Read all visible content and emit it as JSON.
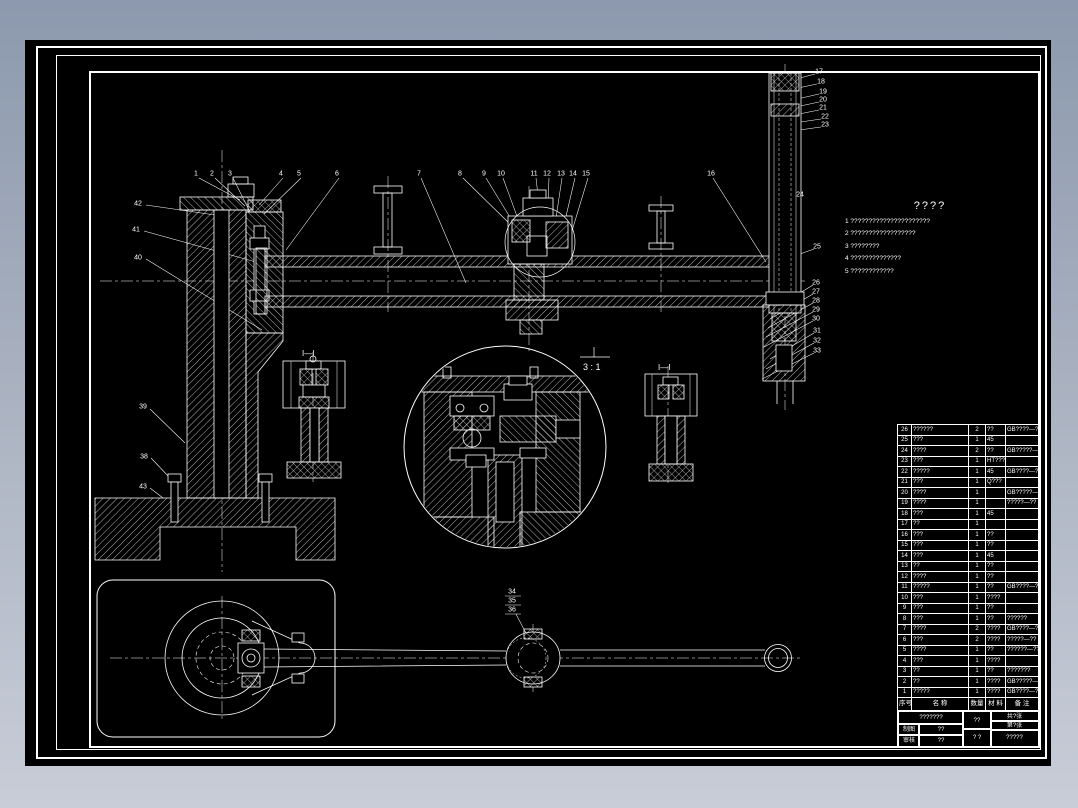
{
  "notes": {
    "title": "????",
    "lines": [
      "1  ??????????????????????",
      "2  ??????????????????",
      "3  ????????",
      "4  ??????????????",
      "5  ????????????"
    ]
  },
  "labels": {
    "detail_scale": "3 : 1",
    "section_i_left": "I—I",
    "section_i_right": "I—I"
  },
  "callouts": [
    {
      "n": "1",
      "x": 196,
      "y": 174
    },
    {
      "n": "2",
      "x": 212,
      "y": 174
    },
    {
      "n": "3",
      "x": 230,
      "y": 174
    },
    {
      "n": "4",
      "x": 281,
      "y": 174
    },
    {
      "n": "5",
      "x": 299,
      "y": 174
    },
    {
      "n": "6",
      "x": 337,
      "y": 174
    },
    {
      "n": "7",
      "x": 419,
      "y": 174
    },
    {
      "n": "8",
      "x": 460,
      "y": 174
    },
    {
      "n": "9",
      "x": 484,
      "y": 174
    },
    {
      "n": "10",
      "x": 501,
      "y": 174
    },
    {
      "n": "11",
      "x": 534,
      "y": 174
    },
    {
      "n": "12",
      "x": 547,
      "y": 174
    },
    {
      "n": "13",
      "x": 561,
      "y": 174
    },
    {
      "n": "14",
      "x": 573,
      "y": 174
    },
    {
      "n": "15",
      "x": 586,
      "y": 174
    },
    {
      "n": "16",
      "x": 711,
      "y": 174
    },
    {
      "n": "42",
      "x": 138,
      "y": 204
    },
    {
      "n": "41",
      "x": 136,
      "y": 230
    },
    {
      "n": "40",
      "x": 138,
      "y": 258
    },
    {
      "n": "39",
      "x": 143,
      "y": 407
    },
    {
      "n": "38",
      "x": 144,
      "y": 457
    },
    {
      "n": "43",
      "x": 143,
      "y": 487
    },
    {
      "n": "17",
      "x": 819,
      "y": 72
    },
    {
      "n": "18",
      "x": 821,
      "y": 82
    },
    {
      "n": "19",
      "x": 823,
      "y": 92
    },
    {
      "n": "20",
      "x": 823,
      "y": 100
    },
    {
      "n": "21",
      "x": 823,
      "y": 108
    },
    {
      "n": "22",
      "x": 825,
      "y": 117
    },
    {
      "n": "23",
      "x": 825,
      "y": 125
    },
    {
      "n": "24",
      "x": 800,
      "y": 195
    },
    {
      "n": "25",
      "x": 817,
      "y": 247
    },
    {
      "n": "26",
      "x": 816,
      "y": 283
    },
    {
      "n": "27",
      "x": 816,
      "y": 292
    },
    {
      "n": "28",
      "x": 816,
      "y": 301
    },
    {
      "n": "29",
      "x": 816,
      "y": 310
    },
    {
      "n": "30",
      "x": 816,
      "y": 319
    },
    {
      "n": "31",
      "x": 817,
      "y": 331
    },
    {
      "n": "32",
      "x": 817,
      "y": 341
    },
    {
      "n": "33",
      "x": 817,
      "y": 351
    },
    {
      "n": "34",
      "x": 512,
      "y": 592
    },
    {
      "n": "35",
      "x": 512,
      "y": 601
    },
    {
      "n": "36",
      "x": 512,
      "y": 610
    }
  ],
  "parts_table": {
    "headers": [
      "序号",
      "名  称",
      "数量",
      "材 料",
      "备  注"
    ],
    "rows": [
      [
        "26",
        "??????",
        "2",
        "??",
        "GB????—??"
      ],
      [
        "25",
        "???",
        "1",
        "45",
        ""
      ],
      [
        "24",
        "????",
        "2",
        "??",
        "GB?????—??"
      ],
      [
        "23",
        "???",
        "1",
        "HT???",
        ""
      ],
      [
        "22",
        "?????",
        "1",
        "45",
        "GB????—??"
      ],
      [
        "21",
        "???",
        "1",
        "Q???",
        ""
      ],
      [
        "20",
        "????",
        "1",
        "",
        "GB?????—??"
      ],
      [
        "19",
        "????",
        "1",
        "",
        "?????—??"
      ],
      [
        "18",
        "???",
        "1",
        "45",
        ""
      ],
      [
        "17",
        "??",
        "1",
        "",
        ""
      ],
      [
        "16",
        "???",
        "1",
        "??",
        ""
      ],
      [
        "15",
        "???",
        "1",
        "??",
        ""
      ],
      [
        "14",
        "???",
        "1",
        "45",
        ""
      ],
      [
        "13",
        "??",
        "1",
        "??",
        ""
      ],
      [
        "12",
        "????",
        "1",
        "??",
        ""
      ],
      [
        "11",
        "?????",
        "1",
        "??",
        "GB????—??"
      ],
      [
        "10",
        "???",
        "1",
        "????",
        ""
      ],
      [
        "9",
        "???",
        "1",
        "??",
        ""
      ],
      [
        "8",
        "???",
        "1",
        "??",
        "??????"
      ],
      [
        "7",
        "????",
        "2",
        "????",
        "GB????—??"
      ],
      [
        "6",
        "???",
        "2",
        "????",
        "?????—??"
      ],
      [
        "5",
        "????",
        "1",
        "??",
        "??????—??"
      ],
      [
        "4",
        "???",
        "1",
        "????",
        ""
      ],
      [
        "3",
        "??",
        "1",
        "??",
        "???????"
      ],
      [
        "2",
        "??",
        "1",
        "????",
        "GB?????—??"
      ],
      [
        "1",
        "?????",
        "1",
        "????",
        "GB????—??"
      ]
    ]
  },
  "title_block": {
    "title": "???????",
    "r1_label": "制图",
    "r1_value": "??",
    "r2_label": "审核",
    "r2_value": "??",
    "mid_top": "??",
    "mid_bottom": "? ?",
    "sheet_top": "共?张",
    "sheet_bottom": "第?张",
    "doc_value": "?????"
  }
}
